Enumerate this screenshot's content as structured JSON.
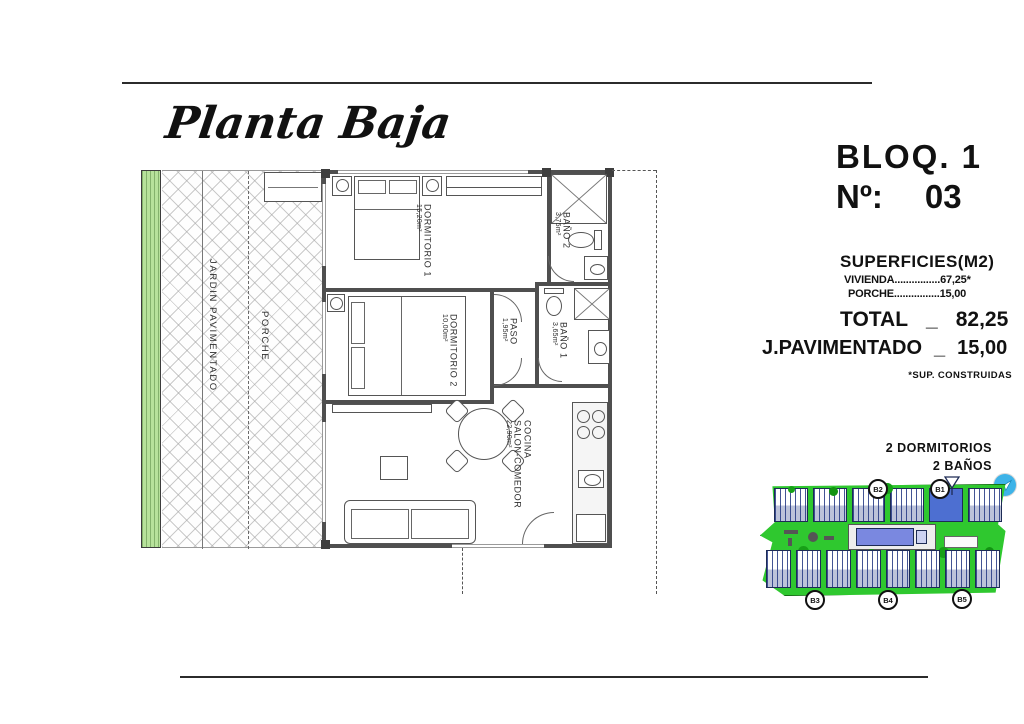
{
  "title": "Planta Baja",
  "block": {
    "name": "BLOQ. 1",
    "number_label": "Nº:",
    "number": "03"
  },
  "surfaces": {
    "heading": "SUPERFICIES(M2)",
    "rows": [
      {
        "label": "VIVIENDA",
        "dots": "................",
        "value": "67,25*"
      },
      {
        "label": "PORCHE",
        "dots": "................",
        "value": "15,00"
      }
    ],
    "total": {
      "label": "TOTAL",
      "sep": "_",
      "value": "82,25"
    },
    "paved": {
      "label": "J.PAVIMENTADO",
      "sep": "_",
      "value": "15,00"
    },
    "footnote": "*SUP. CONSTRUIDAS"
  },
  "floor_plan": {
    "outdoor": {
      "garden": "JARDIN PAVIMENTADO",
      "porch": "PORCHE"
    },
    "rooms": [
      {
        "name": "DORMITORIO 1",
        "area": "15,20m²"
      },
      {
        "name": "BAÑO 2",
        "area": "3,75m²"
      },
      {
        "name": "DORMITORIO 2",
        "area": "10,00m²"
      },
      {
        "name": "PASO",
        "area": "1,95m²"
      },
      {
        "name": "BAÑO 1",
        "area": "3,65m²"
      },
      {
        "name_line1": "COCINA",
        "name_line2": "SALON-COMEDOR",
        "area": "22,90m²"
      }
    ]
  },
  "site_plan": {
    "features": [
      "2 DORMITORIOS",
      "2 BAÑOS"
    ],
    "badges": [
      "B2",
      "B1",
      "B3",
      "B4",
      "B5"
    ],
    "colors": {
      "grass": "#2fc82f",
      "pool": "#7a88e0",
      "selected_unit": "#4d6fd1",
      "nav_icon": "#3db3e8"
    }
  }
}
